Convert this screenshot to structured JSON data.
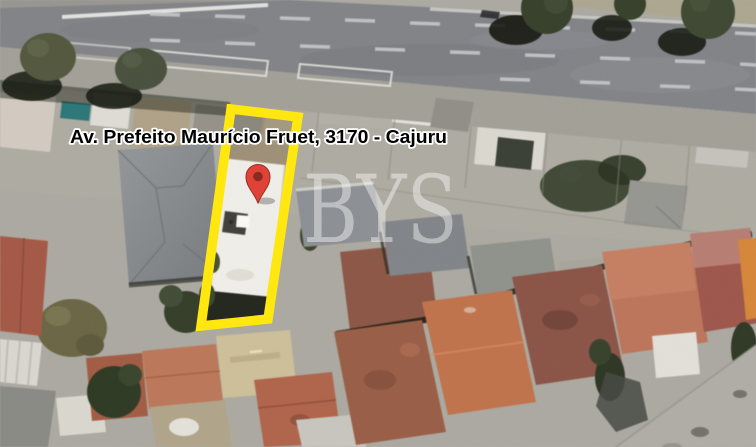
{
  "map": {
    "view_type": "satellite",
    "address_label": "Av. Prefeito Maurício Fruet, 3170 - Cajuru",
    "watermark_text": "BYS",
    "marker": {
      "icon": "red-map-pin-icon",
      "color": "#df4338",
      "inner_dot_color": "#8c2a21"
    },
    "property_highlight": {
      "color": "#ffe70f",
      "shape": "rotated-rectangle-outline"
    }
  }
}
